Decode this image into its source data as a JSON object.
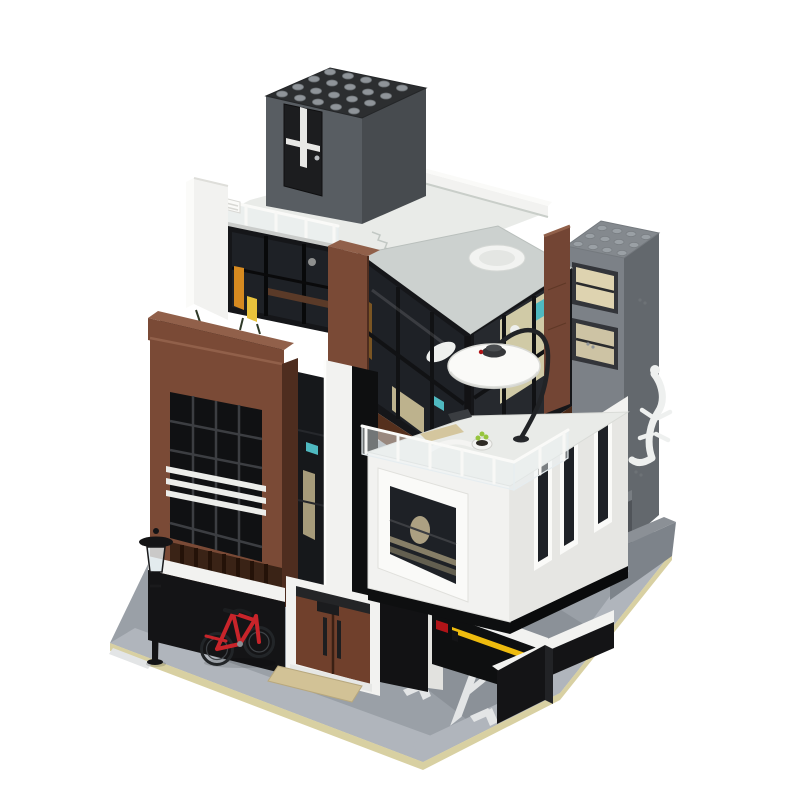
{
  "scene": {
    "type": "product-photo",
    "subject": "LEGO-style modular brick building (MOC) - modern brown and white corner townhouse with rooftop penthouse, corner glass atrium, cantilevered white box and parking ramp",
    "view": "isometric three-quarter on plain white background",
    "background_color": "#ffffff"
  },
  "ground": {
    "parking_letter": "P",
    "markings": [
      "parking letter P",
      "two corner bay lines",
      "white curb dash"
    ],
    "plate_color": "#9aa0a7",
    "driveway_color": "#8b9198",
    "sidewalk_color": "#b0b5bc",
    "edge_color": "#d8d0a2",
    "marking_color": "#e3e5e6"
  },
  "palette": {
    "bg": "#ffffff",
    "plate": "#9aa0a7",
    "sidewalk": "#b0b5bc",
    "driveway": "#8b9198",
    "plateEdge": "#d8d0a2",
    "marking": "#e3e5e6",
    "white": "#f2f2f0",
    "whiteBright": "#fafaf8",
    "whiteShade": "#e2e2df",
    "boxSide": "#e6e6e3",
    "deck": "#e9ebe8",
    "atriumTop": "#ccd1cf",
    "brown": "#7a4a36",
    "brownLight": "#91604a",
    "brownDark": "#4e2d1f",
    "brownPanel": "#734534",
    "doorBrown": "#70402c",
    "soffitBrown": "#55301d",
    "soffitBrown2": "#4a2a19",
    "slatBrown": "#3a2316",
    "frameBlack": "#151619",
    "glassDark": "#1e2126",
    "glassMid": "#26292e",
    "penthouseFront": "#585d62",
    "penthouseSide": "#474b4f",
    "penthouseTop": "#2c2e30",
    "stud": "#8f9499",
    "towerFront": "#7c8187",
    "towerSide": "#63686d",
    "towerTop": "#84898e",
    "towerStud": "#9aa0a5",
    "plinth": "#7d838a",
    "black": "#141416",
    "ink": "#0e0f10",
    "metal": "#3a3d41",
    "red": "#c8242a",
    "redDark": "#b01418",
    "yellow": "#eebb0e",
    "teal": "#4fb9c0",
    "amber": "#d68a20",
    "amberYellow": "#e8c23c",
    "tan": "#d2c296",
    "tanLight": "#ded3b0",
    "interiorTan": "#cbbd92",
    "paleWall": "#e3dcb4"
  },
  "parts": {
    "penthouse": {
      "label": "dark-gray rooftop penthouse",
      "roof_studs_grid": "5 x 4",
      "door": "black door with white cross muntins and silver knob"
    },
    "roof_terrace": {
      "label": "white roof deck with transparent railing, parapet and vent unit"
    },
    "glass_atrium": {
      "label": "black-framed corner glass atrium",
      "skylight": "round white tub visible through roof"
    },
    "arc_lamp": {
      "label": "white disc arc floor lamp over terrace"
    },
    "white_box": {
      "label": "cantilevered white volume with roof terrace",
      "slit_windows": 3,
      "terrace_items": [
        "plant pot",
        "lounge mat",
        "grill"
      ]
    },
    "brown_tower": {
      "label": "reddish-brown window tower",
      "white_stripes": 3,
      "lower_band": "dark brown slats"
    },
    "gray_tower": {
      "label": "light-gray service tower",
      "roof_studs_grid": "5 x 4",
      "ornament": "white gecko relief",
      "windows": "tan-lined double windows"
    },
    "bicycle": {
      "label": "red city bicycle parked in alcove",
      "color": "#c8242a"
    },
    "street_lamp": {
      "label": "black street lamp with clear lantern"
    },
    "entrance": {
      "label": "brown double entrance doors",
      "doors": 2,
      "handles": 2,
      "doormat_color": "#d2c296"
    },
    "parking": {
      "label": "parking ramp with painted letter",
      "letter": "P",
      "barrier_color": "#eebb0e",
      "garage_light": "red"
    },
    "fence": {
      "label": "dark vertical slat fence at driveway"
    },
    "planter": {
      "label": "brown rooftop planter with twigs"
    }
  }
}
